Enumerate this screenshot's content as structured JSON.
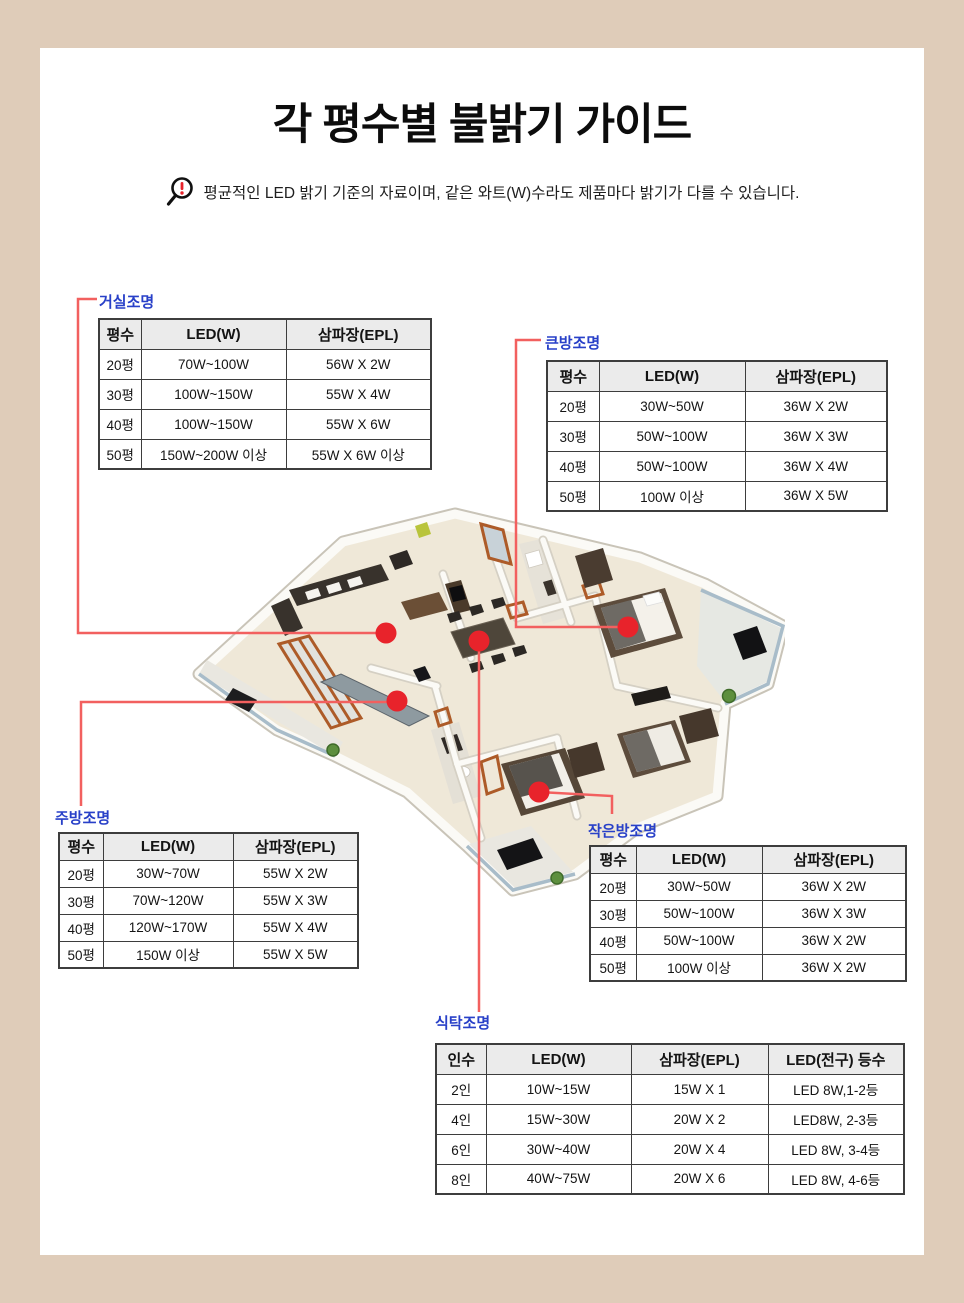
{
  "page": {
    "title": "각 평수별 불밝기 가이드",
    "notice": "평균적인 LED 밝기 기준의 자료이며, 같은 와트(W)수라도 제품마다 밝기가 다를 수 있습니다."
  },
  "colors": {
    "frame_beige": "#dfccb9",
    "content_white": "#ffffff",
    "label_blue": "#2840c8",
    "leader_line_red": "#f2605f",
    "dot_red": "#e8232b",
    "table_header_bg": "#ebebeb",
    "table_border": "#3d3d3d",
    "notice_exclamation_red": "#e8232b"
  },
  "icons": {
    "notice_icon": "magnifier-exclamation-icon"
  },
  "sections": {
    "living": {
      "label": "거실조명",
      "table": {
        "columns": [
          "평수",
          "LED(W)",
          "삼파장(EPL)"
        ],
        "rows": [
          [
            "20평",
            "70W~100W",
            "56W X 2W"
          ],
          [
            "30평",
            "100W~150W",
            "55W X 4W"
          ],
          [
            "40평",
            "100W~150W",
            "55W X 6W"
          ],
          [
            "50평",
            "150W~200W 이상",
            "55W X 6W 이상"
          ]
        ]
      }
    },
    "master_room": {
      "label": "큰방조명",
      "table": {
        "columns": [
          "평수",
          "LED(W)",
          "삼파장(EPL)"
        ],
        "rows": [
          [
            "20평",
            "30W~50W",
            "36W X 2W"
          ],
          [
            "30평",
            "50W~100W",
            "36W X 3W"
          ],
          [
            "40평",
            "50W~100W",
            "36W X 4W"
          ],
          [
            "50평",
            "100W 이상",
            "36W X 5W"
          ]
        ]
      }
    },
    "kitchen": {
      "label": "주방조명",
      "table": {
        "columns": [
          "평수",
          "LED(W)",
          "삼파장(EPL)"
        ],
        "rows": [
          [
            "20평",
            "30W~70W",
            "55W X 2W"
          ],
          [
            "30평",
            "70W~120W",
            "55W X 3W"
          ],
          [
            "40평",
            "120W~170W",
            "55W X 4W"
          ],
          [
            "50평",
            "150W 이상",
            "55W X 5W"
          ]
        ]
      }
    },
    "small_room": {
      "label": "작은방조명",
      "table": {
        "columns": [
          "평수",
          "LED(W)",
          "삼파장(EPL)"
        ],
        "rows": [
          [
            "20평",
            "30W~50W",
            "36W X 2W"
          ],
          [
            "30평",
            "50W~100W",
            "36W X 3W"
          ],
          [
            "40평",
            "50W~100W",
            "36W X 2W"
          ],
          [
            "50평",
            "100W 이상",
            "36W X 2W"
          ]
        ]
      }
    },
    "dining": {
      "label": "식탁조명",
      "table": {
        "columns": [
          "인수",
          "LED(W)",
          "삼파장(EPL)",
          "LED(전구) 등수"
        ],
        "rows": [
          [
            "2인",
            "10W~15W",
            "15W X 1",
            "LED 8W,1-2등"
          ],
          [
            "4인",
            "15W~30W",
            "20W X 2",
            "LED8W, 2-3등"
          ],
          [
            "6인",
            "30W~40W",
            "20W X 4",
            "LED 8W, 3-4등"
          ],
          [
            "8인",
            "40W~75W",
            "20W X 6",
            "LED 8W, 4-6등"
          ]
        ]
      }
    }
  }
}
